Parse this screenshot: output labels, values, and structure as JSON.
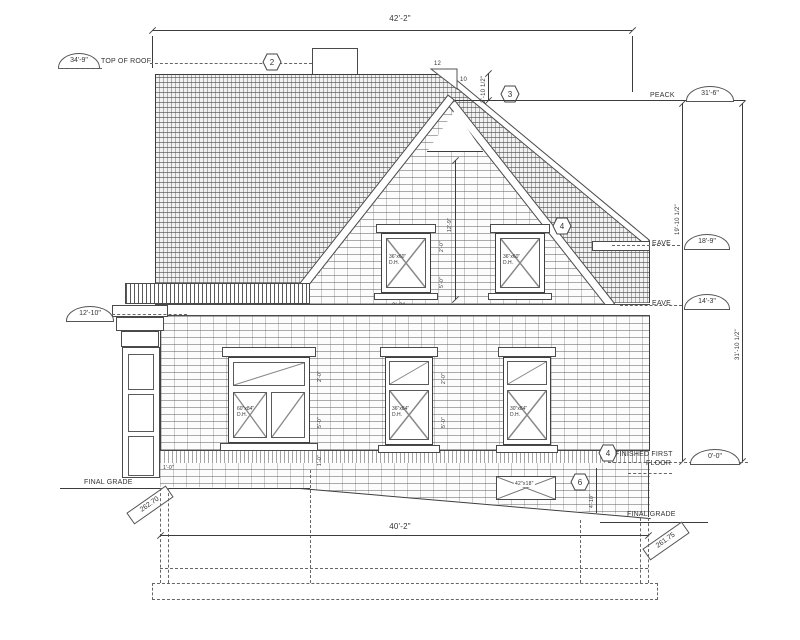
{
  "elevation_labels": {
    "top_of_roof": "TOP OF ROOF",
    "top_of_roof_value": "34'-9\"",
    "peak": "PEACK",
    "peak_value": "31'-6\"",
    "eave": "EAVE",
    "eave_upper_value": "18'-9\"",
    "eave_lower_value": "14'-3\"",
    "balcony_value": "12'-10\"",
    "finished_first": "FINISHED FIRST",
    "floor": "FLOOR",
    "ffl_value": "0'-0\"",
    "final_grade": "FINAL GRADE",
    "grade_left_value": "262.70",
    "grade_right_value": "261.75"
  },
  "dimensions": {
    "overall_width": "42'-2\"",
    "foundation_width": "40'-2\"",
    "attic_height": "19'-10 1/2\"",
    "overall_height": "31'-10 1/2\"",
    "peak_to_roof": "2'-10 1/2\"",
    "gable_height": "12'-9\"",
    "window_offset": "3'-3\"",
    "transom_height": "2'-0\"",
    "window_height": "5'-0\"",
    "sill_height": "1'-0\"",
    "foundation_height": "4'-10\"",
    "slope_rise": "12",
    "slope_run": "10"
  },
  "markers": [
    "2",
    "3",
    "4",
    "4",
    "6"
  ],
  "windows": {
    "upper_size": "36\"x60\"",
    "main_left_size": "60\"x84\"",
    "main_center_size": "36\"x84\"",
    "main_right_size": "30\"x84\"",
    "type": "D.H.",
    "vent_size": "42\"x18\""
  }
}
